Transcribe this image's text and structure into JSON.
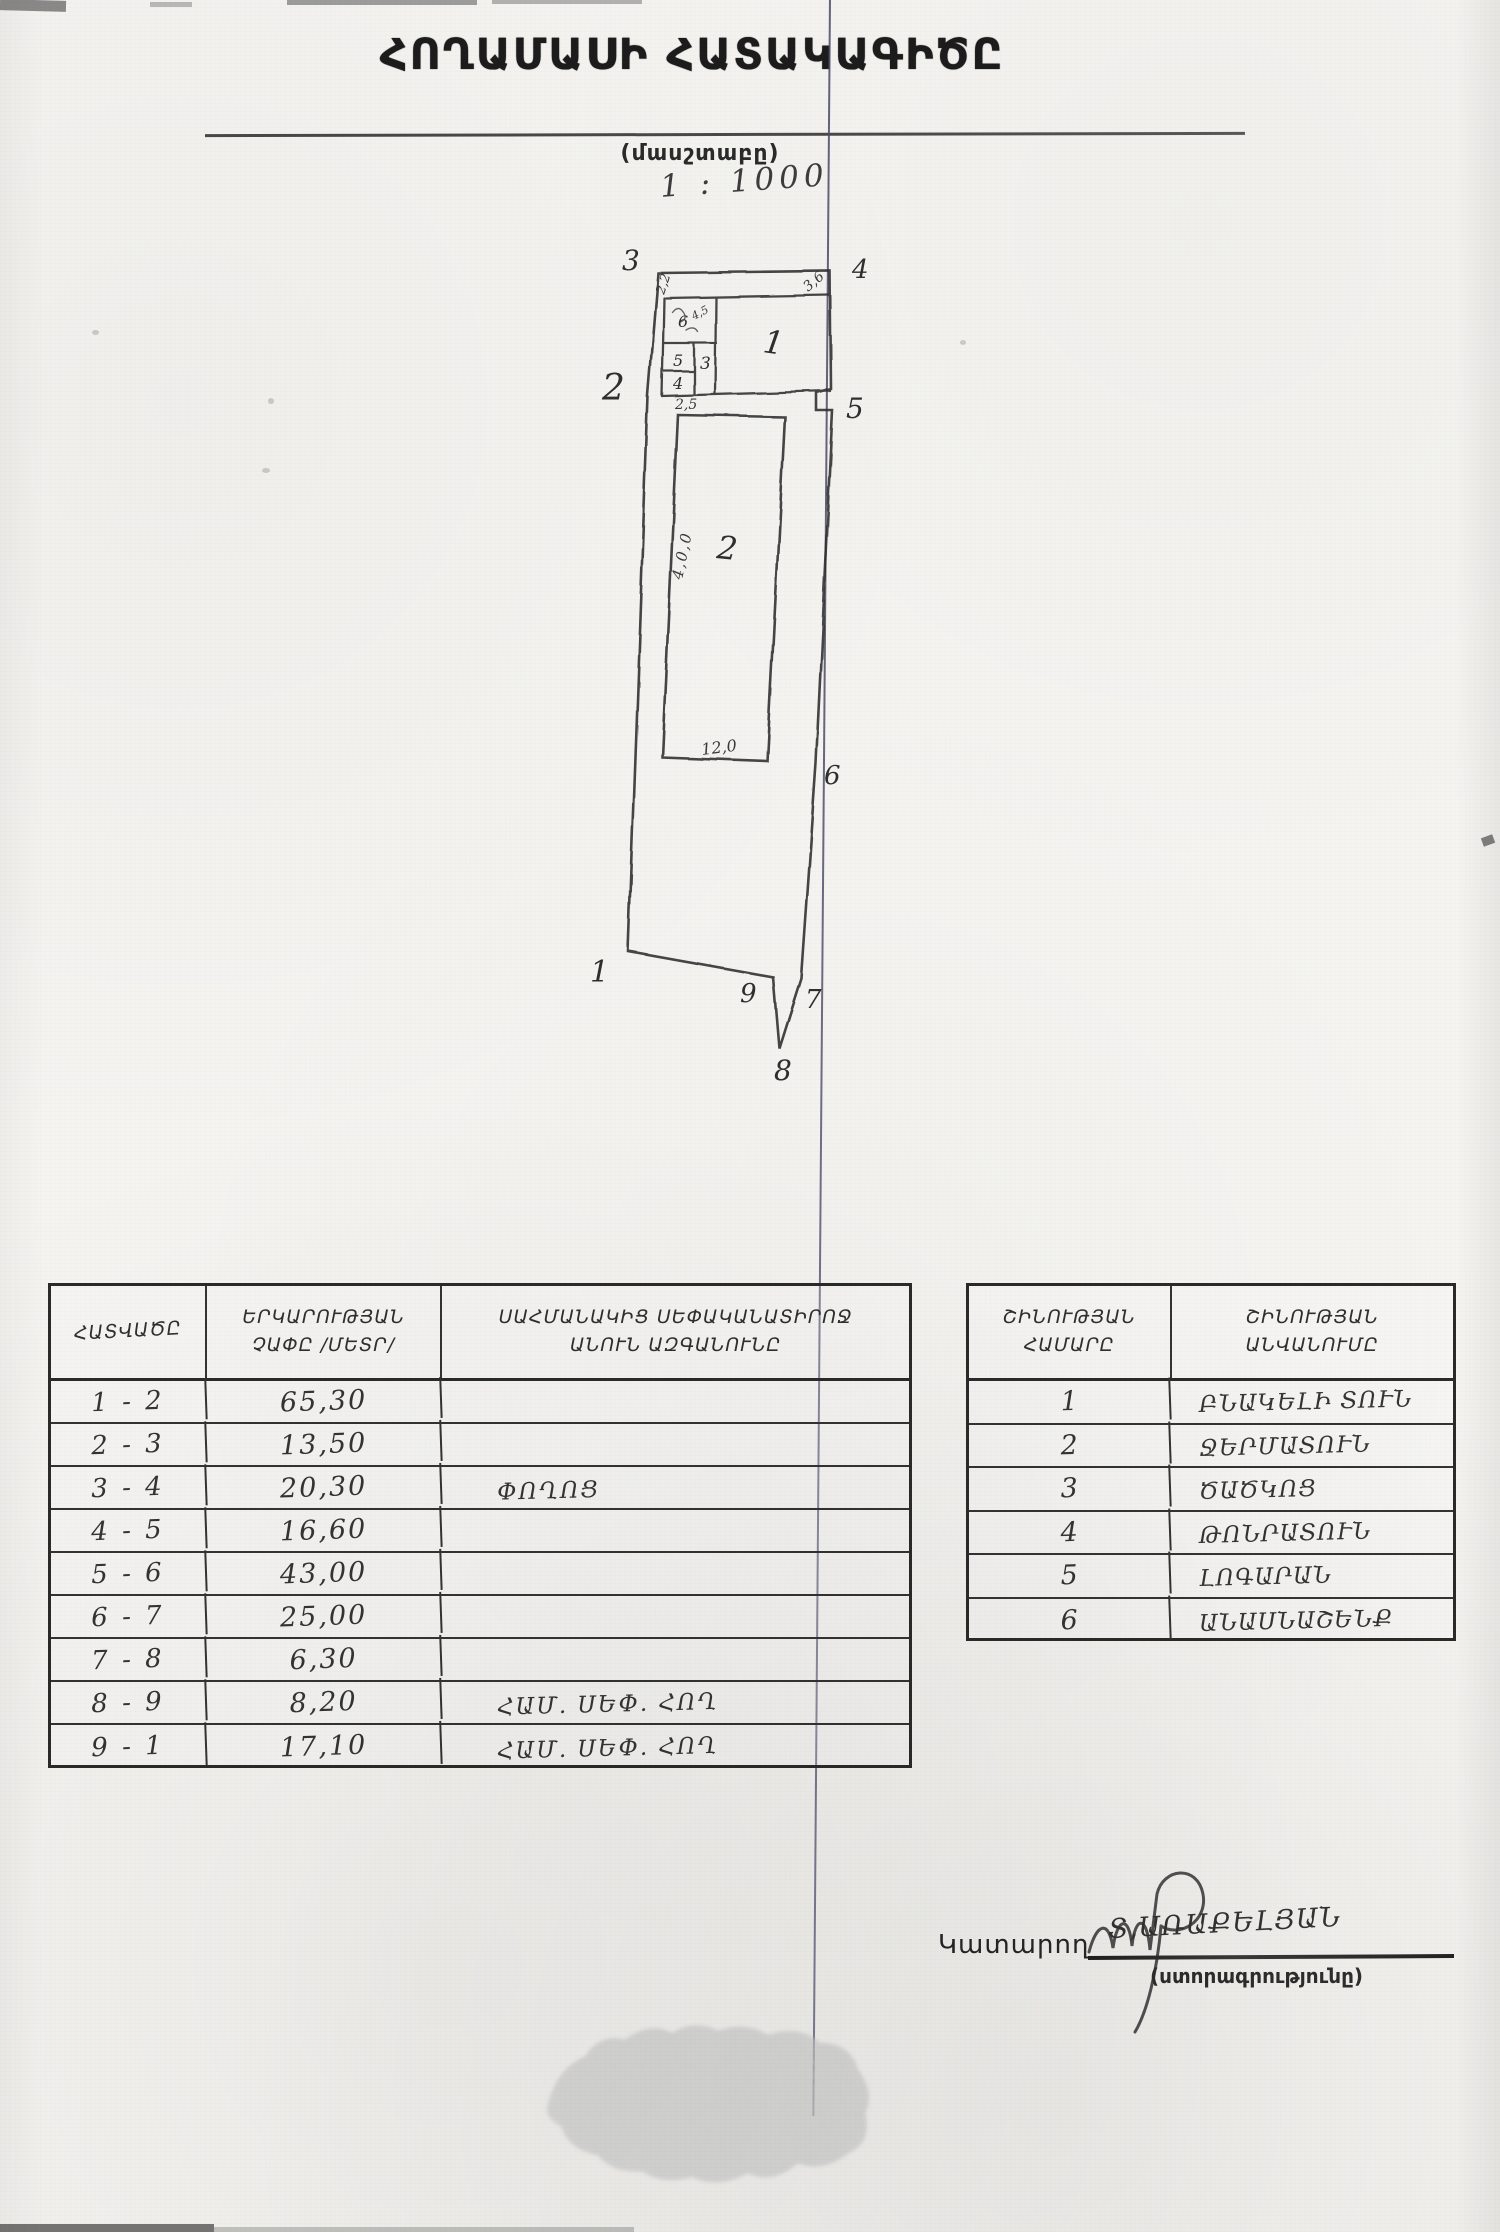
{
  "page": {
    "title": "ՀՈՂԱՄԱՍԻ ՀԱՏԱԿԱԳԻԾԸ",
    "scale_caption": "(մասշտաբը)",
    "scale_value": "1 : 1000"
  },
  "drawing": {
    "boundary_points": {
      "p1": "1",
      "p2": "2",
      "p3": "3",
      "p4": "4",
      "p5": "5",
      "p6": "6",
      "p7": "7",
      "p8": "8",
      "p9": "9"
    },
    "room_labels": {
      "r1": "1",
      "r2": "2",
      "r3": "3",
      "r4": "4",
      "r5": "5",
      "r6": "6"
    },
    "dimensions": {
      "d22": "2,2",
      "d36": "3,6",
      "d25": "2,5",
      "d45": "4,5",
      "d400": "4,0,0",
      "d120": "12,0"
    }
  },
  "boundary_table": {
    "headers": {
      "col1": "ՀԱՏՎԱԾԸ",
      "col2_line1": "ԵՐԿԱՐՈՒԹՅԱՆ",
      "col2_line2": "ՉԱՓԸ /ՄԵՏՐ/",
      "col3_line1": "ՍԱՀՄԱՆԱԿԻՑ ՍԵՓԱԿԱՆԱՏԻՐՈՋ",
      "col3_line2": "ԱՆՈՒՆ ԱԶԳԱՆՈՒՆԸ"
    },
    "rows": [
      {
        "segment": "1 - 2",
        "length": "65,30",
        "neighbor": ""
      },
      {
        "segment": "2 - 3",
        "length": "13,50",
        "neighbor": ""
      },
      {
        "segment": "3 - 4",
        "length": "20,30",
        "neighbor": "ՓՈՂՈՑ"
      },
      {
        "segment": "4 - 5",
        "length": "16,60",
        "neighbor": ""
      },
      {
        "segment": "5 - 6",
        "length": "43,00",
        "neighbor": ""
      },
      {
        "segment": "6 - 7",
        "length": "25,00",
        "neighbor": ""
      },
      {
        "segment": "7 - 8",
        "length": "6,30",
        "neighbor": ""
      },
      {
        "segment": "8 - 9",
        "length": "8,20",
        "neighbor": "ՀԱՄ. ՍԵՓ. ՀՈՂ"
      },
      {
        "segment": "9 - 1",
        "length": "17,10",
        "neighbor": "ՀԱՄ. ՍԵՓ. ՀՈՂ"
      }
    ]
  },
  "building_table": {
    "headers": {
      "col1_line1": "ՇԻՆՈՒԹՅԱՆ",
      "col1_line2": "ՀԱՄԱՐԸ",
      "col2_line1": "ՇԻՆՈՒԹՅԱՆ",
      "col2_line2": "ԱՆՎԱՆՈՒՄԸ"
    },
    "rows": [
      {
        "number": "1",
        "name": "ԲՆԱԿԵԼԻ ՏՈՒՆ"
      },
      {
        "number": "2",
        "name": "ՋԵՐՄԱՏՈՒՆ"
      },
      {
        "number": "3",
        "name": "ԾԱԾԿՈՑ"
      },
      {
        "number": "4",
        "name": "ԹՈՆՐԱՏՈՒՆ"
      },
      {
        "number": "5",
        "name": "ԼՈԳԱՐԱՆ"
      },
      {
        "number": "6",
        "name": "ԱՆԱՍՆԱՇԵՆՔ"
      }
    ]
  },
  "signature": {
    "label": "Կատարող",
    "name": "Տ,ԱՌԱՔԵԼՅԱՆ",
    "caption": "(ստորագրությունը)"
  }
}
